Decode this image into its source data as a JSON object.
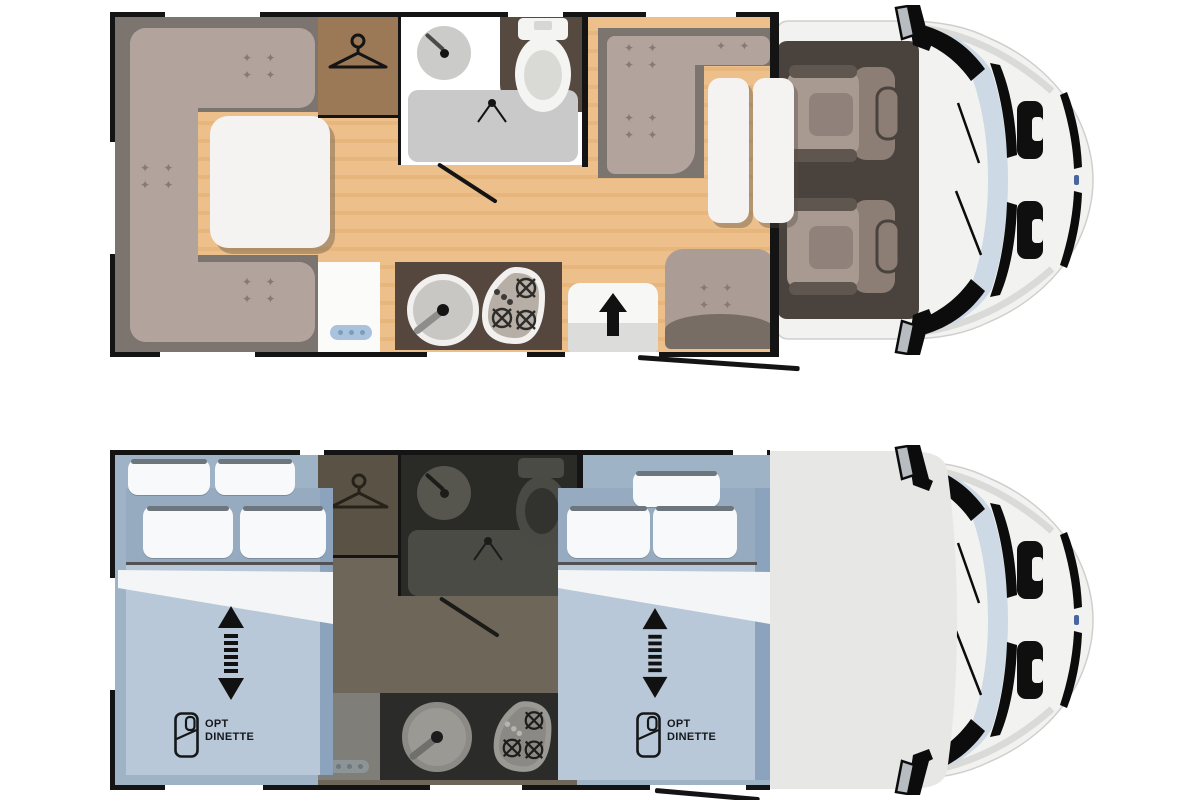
{
  "labels": {
    "night_left_bed": {
      "line1": "OPT",
      "line2": "DINETTE"
    },
    "night_right_bed": {
      "line1": "OPT",
      "line2": "DINETTE"
    }
  },
  "palette": {
    "wall": "#141414",
    "floor": "#edbf8b",
    "floor_stripe": "#e7b67d",
    "lounge_base": "#7b746f",
    "cushion": "#b2a39d",
    "sparkle": "#877a74",
    "table": "#f4f3f1",
    "wardrobe": "#9b7956",
    "bathroom": "#ffffff",
    "shower": "#c9c9c9",
    "toilet_alcove": "#564940",
    "kitchen_counter": "#55473d",
    "fridge_panel_blue": "#a9c3dc",
    "entry_step": "#f7f7f6",
    "cab_body": "#f2f2f1",
    "cab_interior": "#49423d",
    "seat": "#a89a91",
    "seat_dark": "#5f564f",
    "windshield": "#cdd9e4",
    "night_room_blue": "#9fb3c7",
    "night_bed_blue": "#b8c8d8",
    "night_bed_header": "#96abc0",
    "night_bed_edge": "#8ba3bd",
    "sheet_white": "#f3f5f7",
    "pillow": "#f7f9fa",
    "night_corridor": "#6e6759",
    "night_wardrobe": "#5a5245",
    "night_bathroom": "#2a2a27",
    "night_kitchen": "#2b2b29",
    "cab_roof": "#e7e7e6",
    "label_text": "#15181a"
  },
  "icons": [
    "hanger-icon",
    "sink-faucet-icon",
    "shower-faucet-icon",
    "toilet-icon",
    "hob-burner-icon",
    "entry-arrow-icon",
    "bed-extend-arrow-icon",
    "dinette-bed-icon",
    "sparkle-icon",
    "side-mirror-icon"
  ],
  "sparkle_glyph": "✦ ✦"
}
